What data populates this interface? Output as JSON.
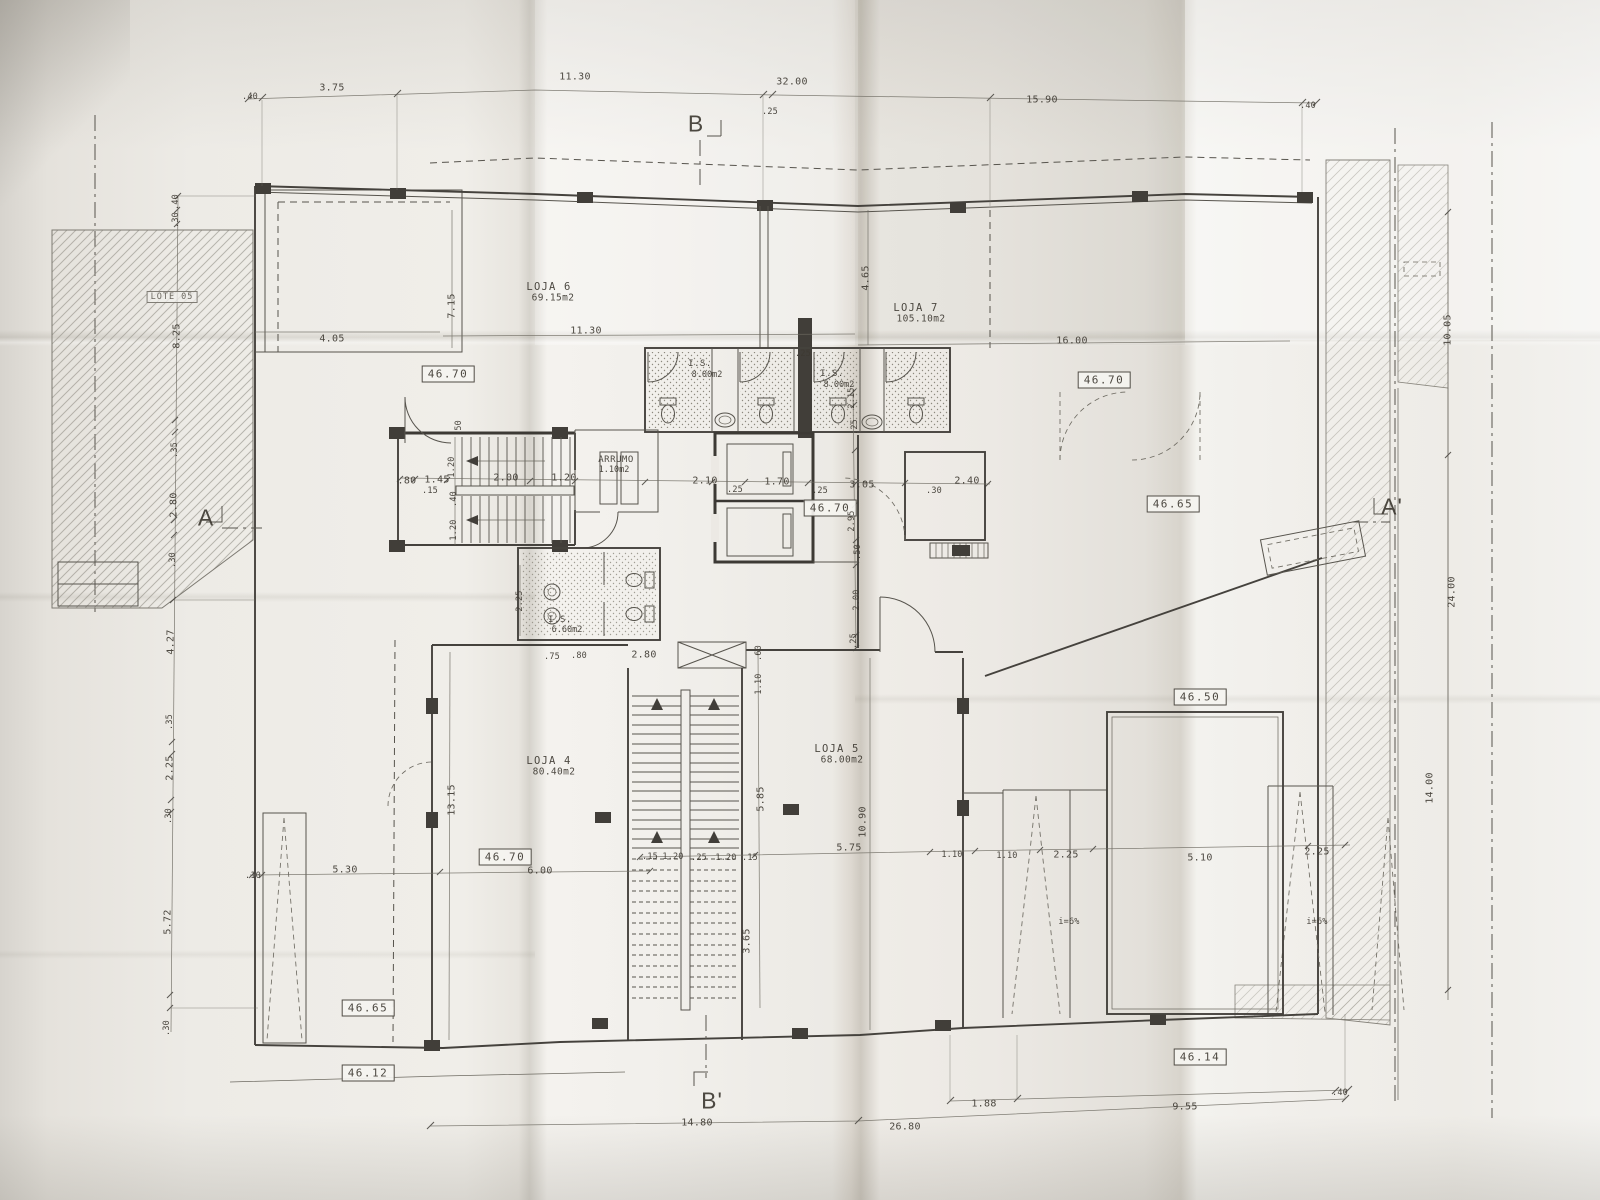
{
  "document": {
    "type": "architectural floor plan (photographed print)",
    "language": "pt"
  },
  "shops": [
    {
      "name": "LOJA 4",
      "area": "80.40m2"
    },
    {
      "name": "LOJA 5",
      "area": "68.00m2"
    },
    {
      "name": "LOJA 6",
      "area": "69.15m2"
    },
    {
      "name": "LOJA 7",
      "area": "105.10m2"
    }
  ],
  "sanitary": [
    {
      "name": "I.S.",
      "area": "8.00m2"
    },
    {
      "name": "I.S.",
      "area": "8.00m2"
    },
    {
      "name": "I.S.",
      "area": "6.60m2"
    }
  ],
  "storage": {
    "name": "ARRUMO",
    "area": "1.10m2"
  },
  "lot": "LOTE 05",
  "levels": [
    "46.70",
    "46.65",
    "46.50",
    "46.14",
    "46.12"
  ],
  "sections": [
    "A",
    "A'",
    "B",
    "B'"
  ],
  "ramp_slope": "i=6%",
  "labels": [
    {
      "t": ".40",
      "x": 250,
      "y": 97,
      "c": "dim-s"
    },
    {
      "t": "3.75",
      "x": 332,
      "y": 88
    },
    {
      "t": "11.30",
      "x": 575,
      "y": 77
    },
    {
      "t": "32.00",
      "x": 792,
      "y": 82
    },
    {
      "t": ".25",
      "x": 770,
      "y": 112,
      "c": "dim-s"
    },
    {
      "t": "15.90",
      "x": 1042,
      "y": 100
    },
    {
      "t": ".40",
      "x": 1308,
      "y": 106,
      "c": "dim-s"
    },
    {
      "t": "B",
      "x": 696,
      "y": 124,
      "c": "big"
    },
    {
      "t": "B'",
      "x": 712,
      "y": 1101,
      "c": "big"
    },
    {
      "t": "A",
      "x": 206,
      "y": 518,
      "c": "big"
    },
    {
      "t": "A'",
      "x": 1392,
      "y": 507,
      "c": "big"
    },
    {
      "t": ".40",
      "x": 176,
      "y": 202,
      "r": -90,
      "c": "dim-s"
    },
    {
      "t": ".30",
      "x": 176,
      "y": 220,
      "r": -90,
      "c": "dim-s"
    },
    {
      "t": "LOTE 05",
      "x": 172,
      "y": 297,
      "c": "lote"
    },
    {
      "t": "8.25",
      "x": 177,
      "y": 336,
      "r": -90
    },
    {
      "t": ".35",
      "x": 175,
      "y": 450,
      "r": -90,
      "c": "dim-s"
    },
    {
      "t": "2.80",
      "x": 174,
      "y": 505,
      "r": -90
    },
    {
      "t": ".30",
      "x": 173,
      "y": 560,
      "r": -90,
      "c": "dim-s"
    },
    {
      "t": "4.27",
      "x": 171,
      "y": 642,
      "r": -90
    },
    {
      "t": ".35",
      "x": 170,
      "y": 722,
      "r": -90,
      "c": "dim-s"
    },
    {
      "t": "2.25",
      "x": 170,
      "y": 768,
      "r": -90
    },
    {
      "t": ".30",
      "x": 169,
      "y": 816,
      "r": -90,
      "c": "dim-s"
    },
    {
      "t": "5.72",
      "x": 168,
      "y": 922,
      "r": -90
    },
    {
      "t": ".30",
      "x": 167,
      "y": 1028,
      "r": -90,
      "c": "dim-s"
    },
    {
      "t": "4.05",
      "x": 332,
      "y": 339
    },
    {
      "t": "7.15",
      "x": 452,
      "y": 306,
      "r": -90
    },
    {
      "t": "LOJA 6",
      "x": 549,
      "y": 287,
      "c": "room"
    },
    {
      "t": "69.15m2",
      "x": 553,
      "y": 298,
      "c": "area"
    },
    {
      "t": "11.30",
      "x": 586,
      "y": 331
    },
    {
      "t": "4.65",
      "x": 866,
      "y": 278,
      "r": -90
    },
    {
      "t": "LOJA 7",
      "x": 916,
      "y": 308,
      "c": "room"
    },
    {
      "t": "105.10m2",
      "x": 921,
      "y": 319,
      "c": "area"
    },
    {
      "t": "16.00",
      "x": 1072,
      "y": 341
    },
    {
      "t": "46.70",
      "x": 1104,
      "y": 380,
      "c": "box"
    },
    {
      "t": "46.70",
      "x": 448,
      "y": 374,
      "c": "box"
    },
    {
      "t": ".50",
      "x": 459,
      "y": 428,
      "r": -90,
      "c": "dim-s"
    },
    {
      "t": "10.05",
      "x": 1448,
      "y": 330,
      "r": -90
    },
    {
      "t": "24.00",
      "x": 1452,
      "y": 592,
      "r": -90
    },
    {
      "t": "14.00",
      "x": 1430,
      "y": 788,
      "r": -90
    },
    {
      "t": "I.S.",
      "x": 700,
      "y": 364,
      "c": "room-s"
    },
    {
      "t": "8.00m2",
      "x": 707,
      "y": 375,
      "c": "area-s"
    },
    {
      "t": ".25",
      "x": 803,
      "y": 354,
      "c": "dim-s"
    },
    {
      "t": "I.S.",
      "x": 832,
      "y": 374,
      "c": "room-s"
    },
    {
      "t": "8.00m2",
      "x": 839,
      "y": 385,
      "c": "area-s"
    },
    {
      "t": "2.15",
      "x": 852,
      "y": 398,
      "r": -90,
      "c": "dim-s"
    },
    {
      "t": ".25",
      "x": 855,
      "y": 427,
      "r": -90,
      "c": "dim-s"
    },
    {
      "t": ".80",
      "x": 407,
      "y": 481
    },
    {
      "t": "1.45",
      "x": 437,
      "y": 480
    },
    {
      "t": ".15",
      "x": 430,
      "y": 491,
      "c": "dim-s"
    },
    {
      "t": "1.20",
      "x": 452,
      "y": 467,
      "r": -90,
      "c": "dim-s"
    },
    {
      "t": ".40",
      "x": 454,
      "y": 499,
      "r": -90,
      "c": "dim-s"
    },
    {
      "t": "1.20",
      "x": 454,
      "y": 530,
      "r": -90,
      "c": "dim-s"
    },
    {
      "t": "2.00",
      "x": 506,
      "y": 478
    },
    {
      "t": "1.20",
      "x": 564,
      "y": 478
    },
    {
      "t": "ARRUMO",
      "x": 616,
      "y": 460,
      "c": "room-s"
    },
    {
      "t": "1.10m2",
      "x": 614,
      "y": 470,
      "c": "area-s"
    },
    {
      "t": "2.10",
      "x": 705,
      "y": 481
    },
    {
      "t": ".25",
      "x": 735,
      "y": 490,
      "c": "dim-s"
    },
    {
      "t": "1.70",
      "x": 777,
      "y": 482
    },
    {
      "t": ".25",
      "x": 820,
      "y": 491,
      "c": "dim-s"
    },
    {
      "t": "3.05",
      "x": 862,
      "y": 485
    },
    {
      "t": ".30",
      "x": 934,
      "y": 491,
      "c": "dim-s"
    },
    {
      "t": "2.40",
      "x": 967,
      "y": 481
    },
    {
      "t": "46.70",
      "x": 830,
      "y": 508,
      "c": "box"
    },
    {
      "t": "2.95",
      "x": 852,
      "y": 521,
      "r": -90,
      "c": "dim-s"
    },
    {
      "t": ".50",
      "x": 858,
      "y": 552,
      "r": -90,
      "c": "dim-s"
    },
    {
      "t": "2.00",
      "x": 857,
      "y": 600,
      "r": -90,
      "c": "dim-s"
    },
    {
      "t": ".25",
      "x": 854,
      "y": 641,
      "r": -90,
      "c": "dim-s"
    },
    {
      "t": "46.65",
      "x": 1173,
      "y": 504,
      "c": "box"
    },
    {
      "t": "I.S.",
      "x": 560,
      "y": 620,
      "c": "room-s"
    },
    {
      "t": "6.60m2",
      "x": 567,
      "y": 630,
      "c": "area-s"
    },
    {
      "t": "2.25",
      "x": 520,
      "y": 601,
      "r": -90,
      "c": "dim-s"
    },
    {
      "t": ".75",
      "x": 552,
      "y": 657,
      "c": "dim-s"
    },
    {
      "t": ".80",
      "x": 579,
      "y": 656,
      "c": "dim-s"
    },
    {
      "t": "2.80",
      "x": 644,
      "y": 655
    },
    {
      "t": ".60",
      "x": 759,
      "y": 653,
      "r": -90,
      "c": "dim-s"
    },
    {
      "t": "1.10",
      "x": 759,
      "y": 684,
      "r": -90,
      "c": "dim-s"
    },
    {
      "t": "13.15",
      "x": 452,
      "y": 800,
      "r": -90
    },
    {
      "t": "LOJA 4",
      "x": 549,
      "y": 761,
      "c": "room"
    },
    {
      "t": "80.40m2",
      "x": 554,
      "y": 772,
      "c": "area"
    },
    {
      "t": "5.85",
      "x": 761,
      "y": 799,
      "r": -90
    },
    {
      "t": "3.65",
      "x": 747,
      "y": 941,
      "r": -90
    },
    {
      "t": "LOJA 5",
      "x": 837,
      "y": 749,
      "c": "room"
    },
    {
      "t": "68.00m2",
      "x": 842,
      "y": 760,
      "c": "area"
    },
    {
      "t": "10.90",
      "x": 863,
      "y": 822,
      "r": -90
    },
    {
      "t": "5.75",
      "x": 849,
      "y": 848
    },
    {
      "t": ".15",
      "x": 650,
      "y": 857,
      "c": "dim-s"
    },
    {
      "t": "1.20",
      "x": 673,
      "y": 857,
      "c": "dim-s"
    },
    {
      "t": ".25",
      "x": 699,
      "y": 858,
      "c": "dim-s"
    },
    {
      "t": "1.20",
      "x": 726,
      "y": 858,
      "c": "dim-s"
    },
    {
      "t": ".15",
      "x": 750,
      "y": 858,
      "c": "dim-s"
    },
    {
      "t": "46.70",
      "x": 505,
      "y": 857,
      "c": "box"
    },
    {
      "t": "6.00",
      "x": 540,
      "y": 871
    },
    {
      "t": ".10",
      "x": 253,
      "y": 876,
      "c": "dim-s"
    },
    {
      "t": "5.30",
      "x": 345,
      "y": 870
    },
    {
      "t": "1.10",
      "x": 952,
      "y": 855,
      "c": "dim-s"
    },
    {
      "t": "1.10",
      "x": 1007,
      "y": 856,
      "c": "dim-s"
    },
    {
      "t": "2.25",
      "x": 1066,
      "y": 855
    },
    {
      "t": "5.10",
      "x": 1200,
      "y": 858
    },
    {
      "t": "2.25",
      "x": 1317,
      "y": 852
    },
    {
      "t": "i=6%",
      "x": 1069,
      "y": 922,
      "c": "dim-s"
    },
    {
      "t": "i=6%",
      "x": 1317,
      "y": 922,
      "c": "dim-s"
    },
    {
      "t": "46.50",
      "x": 1200,
      "y": 697,
      "c": "box"
    },
    {
      "t": "46.65",
      "x": 368,
      "y": 1008,
      "c": "box"
    },
    {
      "t": "46.12",
      "x": 368,
      "y": 1073,
      "c": "box"
    },
    {
      "t": "46.14",
      "x": 1200,
      "y": 1057,
      "c": "box"
    },
    {
      "t": "14.80",
      "x": 697,
      "y": 1123
    },
    {
      "t": "26.80",
      "x": 905,
      "y": 1127
    },
    {
      "t": "1.88",
      "x": 984,
      "y": 1104
    },
    {
      "t": "9.55",
      "x": 1185,
      "y": 1107
    },
    {
      "t": ".40",
      "x": 1340,
      "y": 1093,
      "c": "dim-s"
    }
  ]
}
